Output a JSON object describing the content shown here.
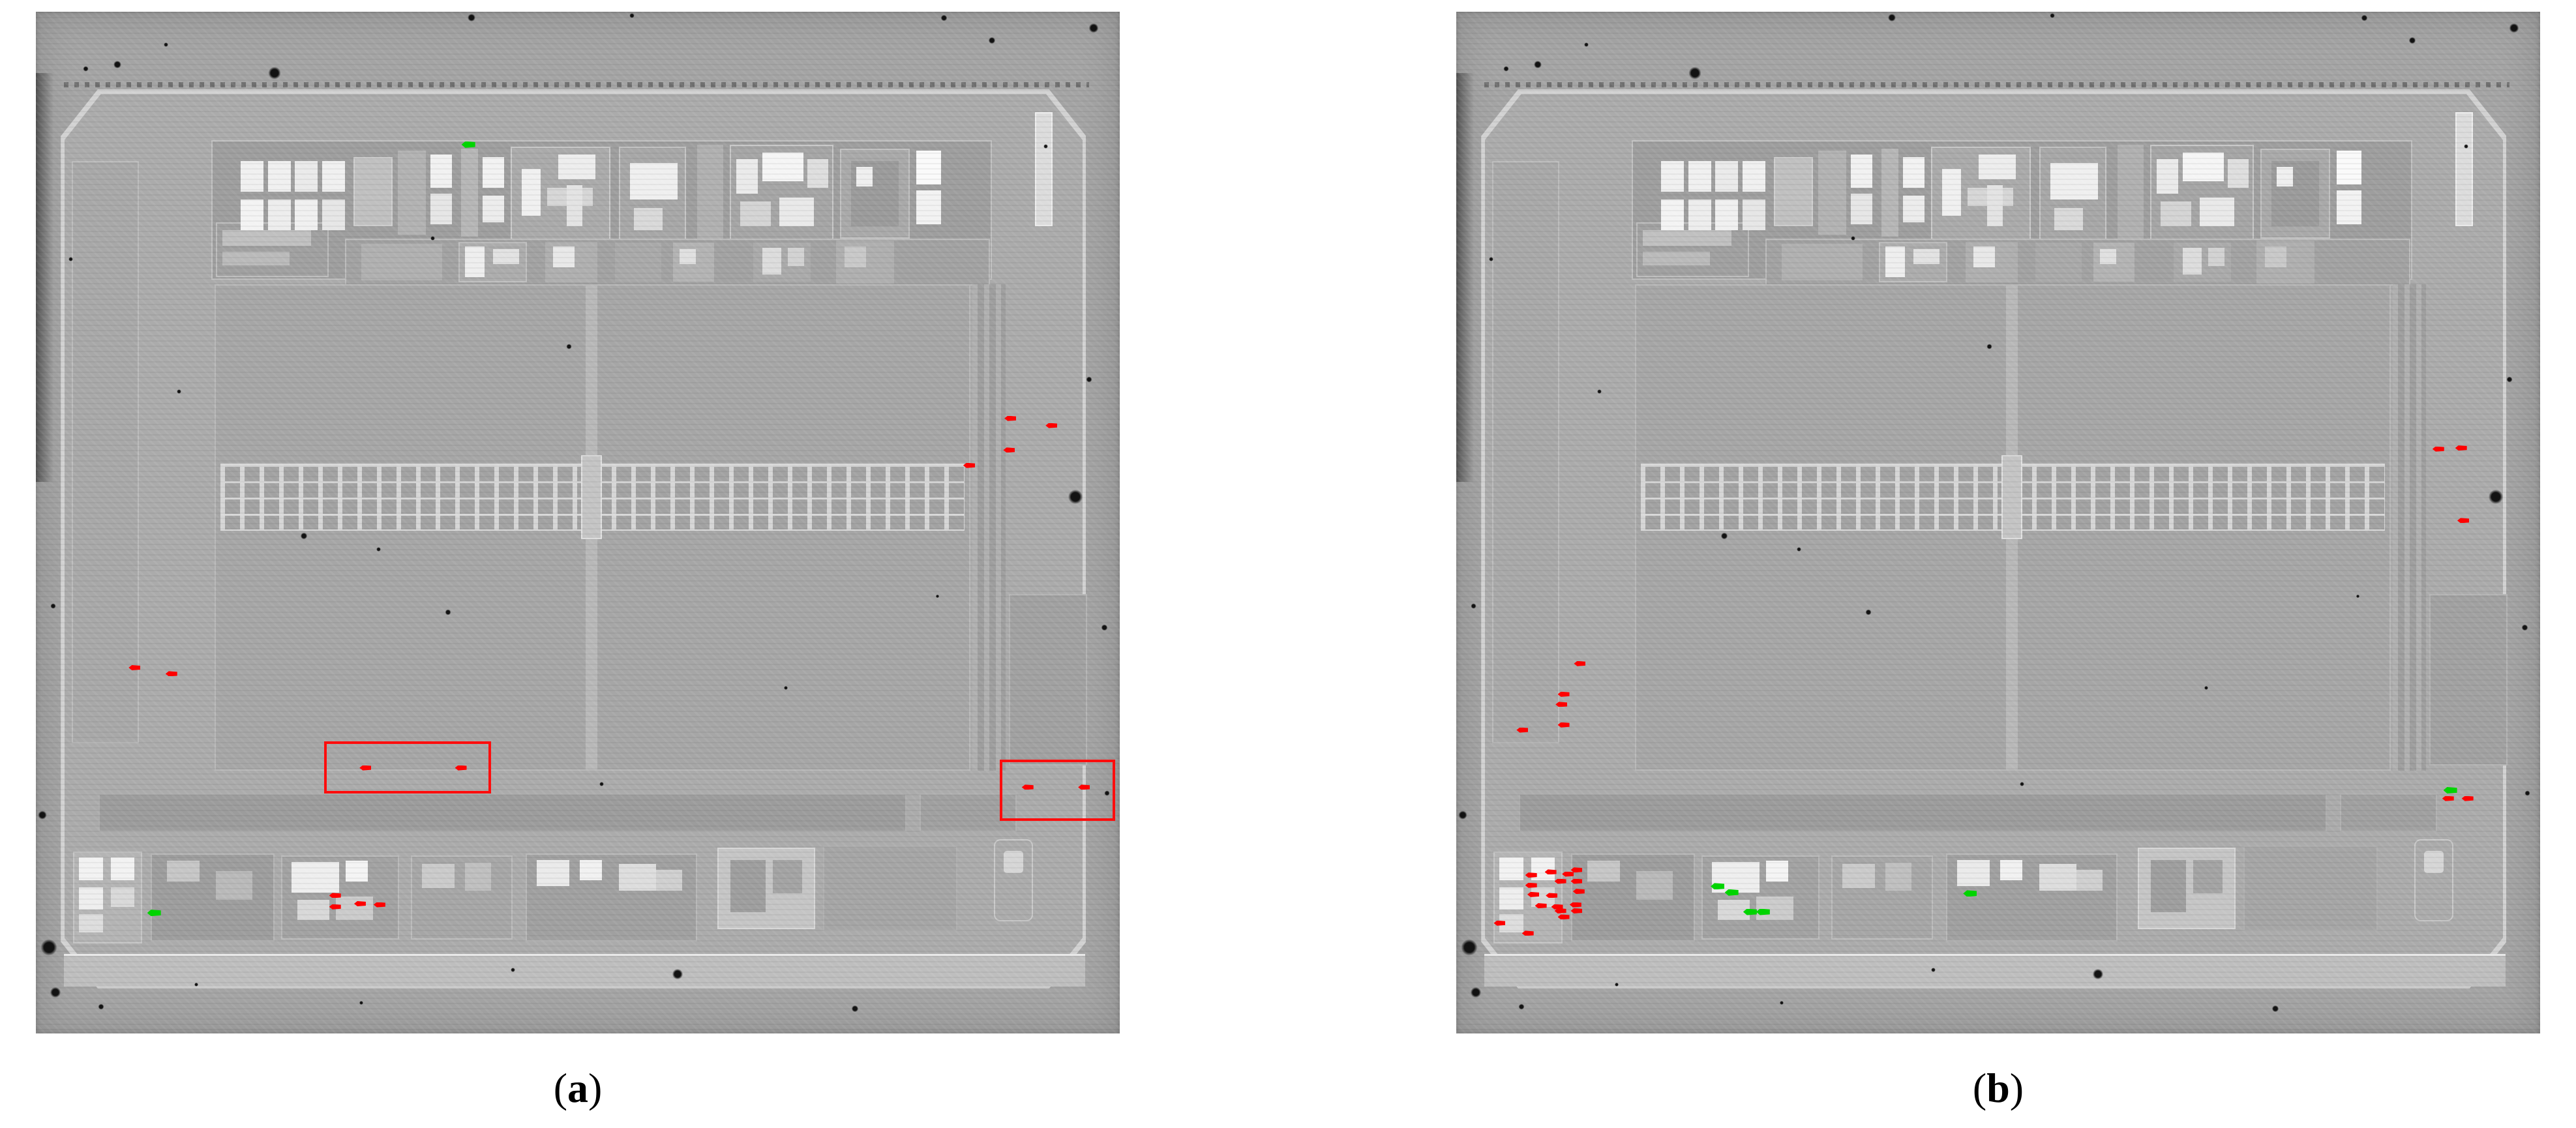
{
  "figure": {
    "colors": {
      "defect_red": "#ff0000",
      "match_green": "#00d400",
      "box_red": "#ff0d0d"
    },
    "marker_style": {
      "red_w": 18,
      "red_h": 8,
      "green_w": 21,
      "green_h": 10,
      "box_border": 4
    },
    "panels": [
      {
        "id": "a",
        "caption": {
          "open": "(",
          "letter": "a",
          "close": ")"
        },
        "red_markers": [
          [
            9.1,
            64.2
          ],
          [
            12.5,
            64.8
          ],
          [
            89.9,
            39.8
          ],
          [
            93.7,
            40.5
          ],
          [
            89.8,
            42.9
          ],
          [
            86.1,
            44.4
          ],
          [
            30.4,
            74.0
          ],
          [
            39.2,
            74.0
          ],
          [
            91.5,
            75.9
          ],
          [
            96.7,
            75.9
          ],
          [
            27.6,
            86.5
          ],
          [
            27.6,
            87.6
          ],
          [
            29.9,
            87.3
          ],
          [
            31.7,
            87.4
          ]
        ],
        "green_markers": [
          [
            39.9,
            13.0
          ],
          [
            10.9,
            88.2
          ]
        ],
        "boxes": [
          [
            26.6,
            71.4,
            14.9,
            4.6
          ],
          [
            88.9,
            73.2,
            10.2,
            5.5
          ]
        ]
      },
      {
        "id": "b",
        "caption": {
          "open": "(",
          "letter": "b",
          "close": ")"
        },
        "red_markers": [
          [
            11.4,
            63.8
          ],
          [
            9.9,
            66.8
          ],
          [
            9.7,
            67.8
          ],
          [
            9.9,
            69.8
          ],
          [
            6.1,
            70.3
          ],
          [
            90.6,
            42.8
          ],
          [
            92.7,
            42.7
          ],
          [
            92.9,
            49.8
          ],
          [
            91.5,
            77.0
          ],
          [
            93.3,
            77.0
          ],
          [
            6.9,
            84.5
          ],
          [
            8.7,
            84.2
          ],
          [
            10.3,
            84.4
          ],
          [
            11.1,
            84.0
          ],
          [
            9.6,
            85.1
          ],
          [
            11.1,
            85.1
          ],
          [
            6.9,
            85.5
          ],
          [
            11.3,
            86.1
          ],
          [
            7.1,
            86.4
          ],
          [
            8.8,
            86.5
          ],
          [
            7.8,
            87.5
          ],
          [
            9.3,
            87.6
          ],
          [
            11.0,
            87.4
          ],
          [
            9.6,
            88.0
          ],
          [
            11.1,
            88.0
          ],
          [
            9.9,
            88.6
          ],
          [
            4.0,
            89.2
          ],
          [
            6.6,
            90.2
          ]
        ],
        "green_markers": [
          [
            91.7,
            76.2
          ],
          [
            24.1,
            85.6
          ],
          [
            25.4,
            86.2
          ],
          [
            27.1,
            88.1
          ],
          [
            28.3,
            88.1
          ],
          [
            47.4,
            86.3
          ]
        ],
        "boxes": []
      }
    ],
    "dust": [
      [
        22.0,
        6.0,
        26
      ],
      [
        7.5,
        5.2,
        16
      ],
      [
        4.6,
        5.6,
        11
      ],
      [
        12.0,
        3.2,
        9
      ],
      [
        40.2,
        0.6,
        16
      ],
      [
        55.0,
        0.4,
        10
      ],
      [
        83.8,
        0.6,
        13
      ],
      [
        97.6,
        1.6,
        20
      ],
      [
        88.2,
        2.8,
        14
      ],
      [
        95.9,
        47.5,
        30
      ],
      [
        97.2,
        36.0,
        12
      ],
      [
        98.6,
        60.3,
        13
      ],
      [
        98.8,
        76.5,
        11
      ],
      [
        24.7,
        51.3,
        14
      ],
      [
        31.6,
        52.6,
        9
      ],
      [
        38.0,
        58.8,
        12
      ],
      [
        49.2,
        32.8,
        11
      ],
      [
        36.6,
        22.2,
        9
      ],
      [
        13.2,
        37.2,
        9
      ],
      [
        3.2,
        24.2,
        9
      ],
      [
        1.6,
        58.2,
        11
      ],
      [
        0.6,
        78.6,
        18
      ],
      [
        1.2,
        91.6,
        34
      ],
      [
        1.8,
        96.0,
        22
      ],
      [
        6.0,
        97.4,
        12
      ],
      [
        59.2,
        94.2,
        22
      ],
      [
        75.6,
        97.6,
        14
      ],
      [
        52.2,
        75.6,
        9
      ],
      [
        69.2,
        66.2,
        8
      ],
      [
        93.2,
        13.2,
        9
      ],
      [
        83.2,
        57.2,
        7
      ],
      [
        44.0,
        93.8,
        9
      ],
      [
        30.0,
        97.0,
        8
      ],
      [
        14.8,
        95.2,
        8
      ]
    ]
  }
}
